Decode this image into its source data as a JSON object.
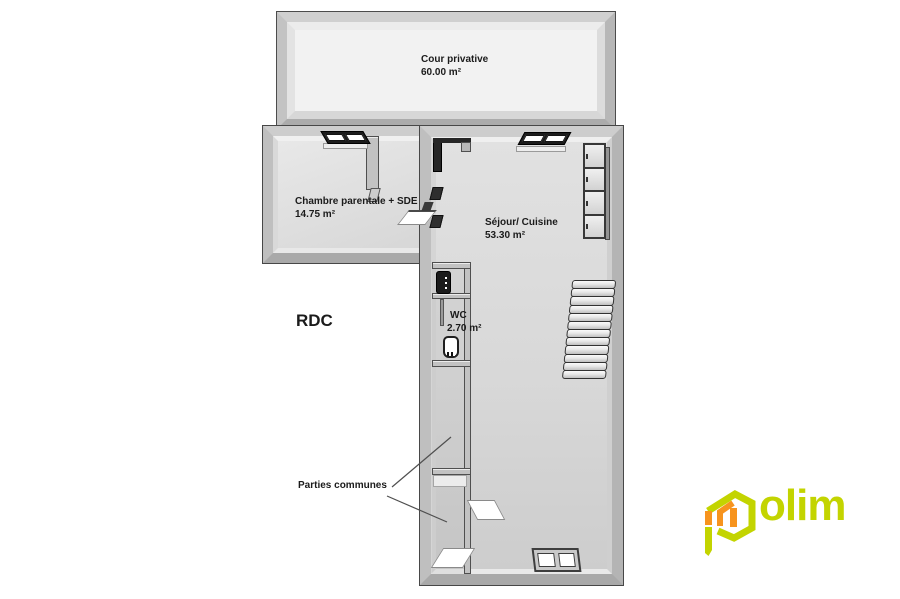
{
  "floor": {
    "label": "RDC"
  },
  "rooms": {
    "courtyard": {
      "name": "Cour privative",
      "area": "60.00 m²"
    },
    "bedroom": {
      "name": "Chambre parentale + SDE",
      "area": "14.75 m²"
    },
    "living": {
      "name": "Séjour/ Cuisine",
      "area": "53.30 m²"
    },
    "wc": {
      "name": "WC",
      "area": "2.70 m²"
    },
    "common_areas": {
      "name": "Parties communes"
    }
  },
  "branding": {
    "brand": "polim",
    "logo_text": "olim",
    "colors": {
      "primary": "#c3d400",
      "accent": "#f7941e"
    }
  },
  "palette": {
    "wall_gray": "#c2c2c2",
    "floor_gray": "#d8d8d8",
    "courtyard_floor": "#f2f2f2",
    "outline": "#4a4a4a",
    "label_text": "#1b1b1b"
  },
  "symbols": {
    "window": "window-icon",
    "door": "door-icon",
    "stairs": "stairs-icon",
    "toilet": "toilet-icon",
    "water_heater": "water-heater-icon",
    "kitchen_cabinets": "kitchen-cabinets-icon",
    "logo_house": "polim-house-icon"
  }
}
